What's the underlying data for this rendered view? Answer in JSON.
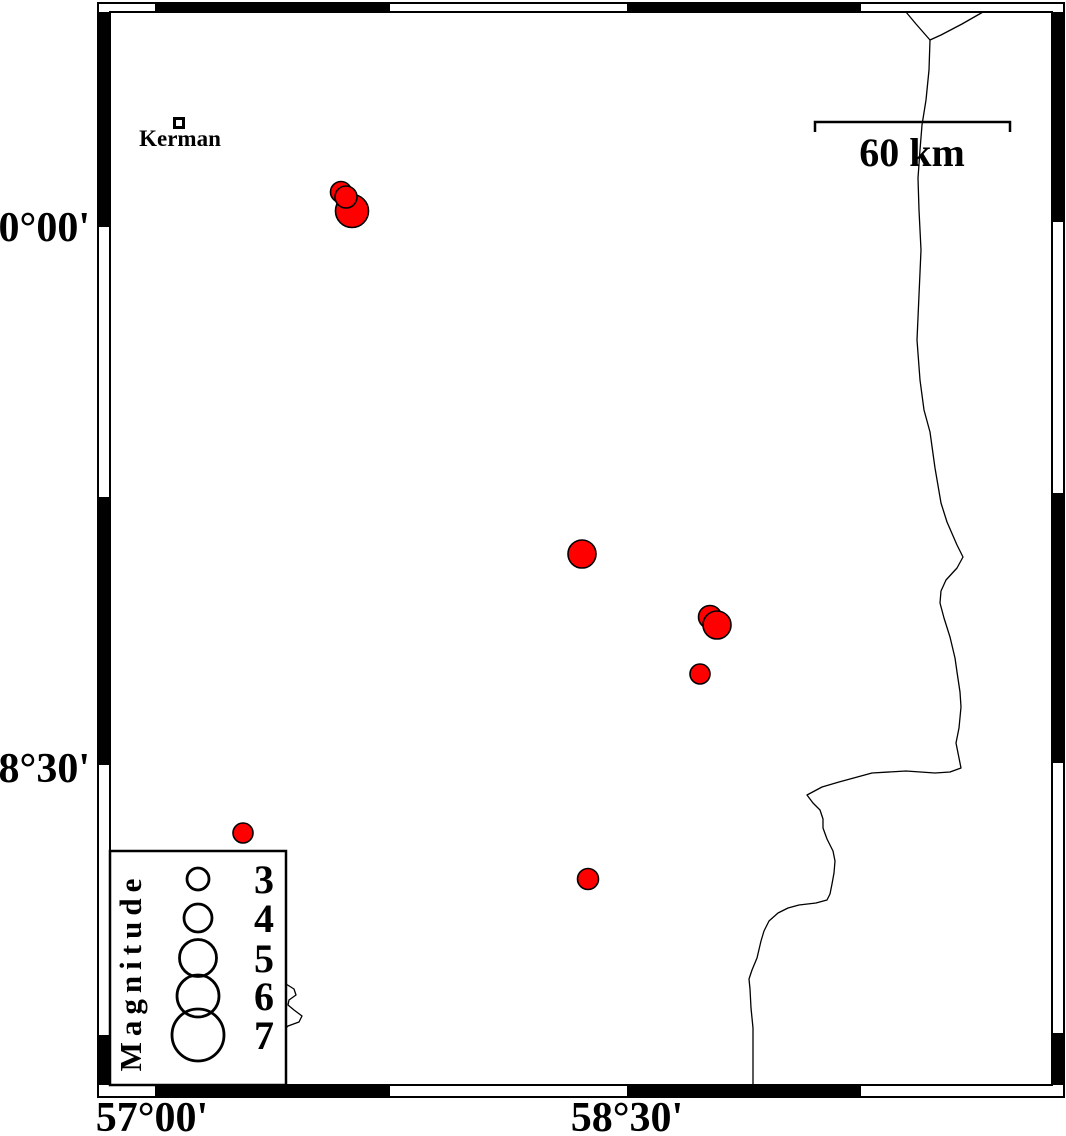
{
  "map": {
    "background_color": "#ffffff",
    "epicenter_color": "#ff0000",
    "frame_color": "#000000",
    "frame": {
      "outer": {
        "x": 98,
        "y": 3,
        "w": 966,
        "h": 1094
      },
      "inner": {
        "x": 110,
        "y": 12,
        "w": 942,
        "h": 1073
      },
      "top_black_segments": [
        [
          155,
          390
        ],
        [
          627,
          861
        ]
      ],
      "bottom_black_segments": [
        [
          155,
          390
        ],
        [
          627,
          861
        ]
      ],
      "left_black_segments": [
        [
          12,
          227
        ],
        [
          497,
          765
        ],
        [
          1035,
          1085
        ]
      ],
      "right_black_segments": [
        [
          12,
          222
        ],
        [
          493,
          763
        ],
        [
          1033,
          1085
        ]
      ]
    },
    "axis_labels": {
      "left": [
        {
          "text": "30°00'",
          "value": "30 deg 00 min N",
          "y": 227
        },
        {
          "text": "28°30'",
          "value": "28 deg 30 min N",
          "y": 768
        }
      ],
      "bottom": [
        {
          "text": "57°00'",
          "value": "57 deg 00 min E",
          "x": 152
        },
        {
          "text": "58°30'",
          "value": "58 deg 30 min E",
          "x": 627
        }
      ]
    },
    "city": {
      "name": "Kerman",
      "marker": {
        "x": 179,
        "y": 123,
        "size": 12
      }
    },
    "scale_bar": {
      "label": "60 km",
      "x1": 815,
      "x2": 1010,
      "y": 122,
      "tick_len": 10
    },
    "legend": {
      "title": "Magnitude",
      "box": {
        "x": 110,
        "y": 851,
        "w": 176,
        "h": 234
      },
      "circle_x": 198,
      "label_x": 264,
      "entries": [
        {
          "label": "3",
          "magnitude": 3,
          "r": 11,
          "y": 879
        },
        {
          "label": "4",
          "magnitude": 4,
          "r": 14,
          "y": 918
        },
        {
          "label": "5",
          "magnitude": 5,
          "r": 18.5,
          "y": 958
        },
        {
          "label": "6",
          "magnitude": 6,
          "r": 21,
          "y": 996
        },
        {
          "label": "7",
          "magnitude": 7,
          "r": 26,
          "y": 1035
        }
      ]
    },
    "epicenters": [
      {
        "x": 352,
        "y": 211,
        "r": 16.5
      },
      {
        "x": 341,
        "y": 192,
        "r": 10.5
      },
      {
        "x": 346,
        "y": 197,
        "r": 11
      },
      {
        "x": 582,
        "y": 554,
        "r": 14
      },
      {
        "x": 710,
        "y": 617,
        "r": 11.5
      },
      {
        "x": 717,
        "y": 625,
        "r": 14
      },
      {
        "x": 700,
        "y": 674,
        "r": 10
      },
      {
        "x": 243,
        "y": 833,
        "r": 10
      },
      {
        "x": 588,
        "y": 879,
        "r": 10.5
      }
    ],
    "roads": [
      {
        "name": "main-road",
        "points": [
          [
            906,
            12
          ],
          [
            916,
            24
          ],
          [
            930,
            40
          ],
          [
            929,
            70
          ],
          [
            926,
            100
          ],
          [
            922,
            125
          ],
          [
            920,
            150
          ],
          [
            918,
            178
          ],
          [
            919,
            210
          ],
          [
            921,
            250
          ],
          [
            919,
            295
          ],
          [
            917,
            340
          ],
          [
            920,
            380
          ],
          [
            924,
            410
          ],
          [
            930,
            432
          ],
          [
            935,
            468
          ],
          [
            941,
            503
          ],
          [
            947,
            522
          ],
          [
            957,
            545
          ],
          [
            963,
            557
          ],
          [
            957,
            568
          ],
          [
            946,
            580
          ],
          [
            941,
            591
          ],
          [
            940,
            603
          ],
          [
            944,
            618
          ],
          [
            950,
            637
          ],
          [
            955,
            658
          ],
          [
            957,
            672
          ],
          [
            960,
            692
          ],
          [
            961,
            707
          ],
          [
            959,
            728
          ],
          [
            956,
            743
          ],
          [
            959,
            758
          ],
          [
            961,
            768
          ],
          [
            950,
            772
          ],
          [
            935,
            773
          ],
          [
            906,
            771
          ],
          [
            872,
            773
          ],
          [
            839,
            782
          ],
          [
            822,
            787
          ],
          [
            807,
            795
          ],
          [
            813,
            803
          ],
          [
            820,
            810
          ],
          [
            823,
            819
          ],
          [
            823,
            828
          ],
          [
            827,
            839
          ],
          [
            833,
            851
          ],
          [
            835,
            861
          ],
          [
            834,
            873
          ],
          [
            832,
            884
          ],
          [
            830,
            894
          ],
          [
            827,
            900
          ],
          [
            816,
            903
          ],
          [
            799,
            905
          ],
          [
            788,
            908
          ],
          [
            778,
            913
          ],
          [
            769,
            921
          ],
          [
            764,
            931
          ],
          [
            761,
            941
          ],
          [
            757,
            958
          ],
          [
            752,
            970
          ],
          [
            749,
            979
          ],
          [
            750,
            989
          ],
          [
            751,
            1008
          ],
          [
            753,
            1028
          ],
          [
            753,
            1060
          ],
          [
            753,
            1085
          ]
        ]
      },
      {
        "name": "road-branch",
        "points": [
          [
            983,
            12
          ],
          [
            962,
            24
          ],
          [
            941,
            35
          ],
          [
            930,
            40
          ]
        ]
      },
      {
        "name": "contour-fragment",
        "points": [
          [
            286,
            984
          ],
          [
            294,
            989
          ],
          [
            296,
            995
          ],
          [
            289,
            1000
          ],
          [
            288,
            1005
          ],
          [
            294,
            1010
          ],
          [
            302,
            1016
          ],
          [
            299,
            1022
          ],
          [
            288,
            1026
          ],
          [
            286,
            1028
          ]
        ]
      }
    ]
  }
}
